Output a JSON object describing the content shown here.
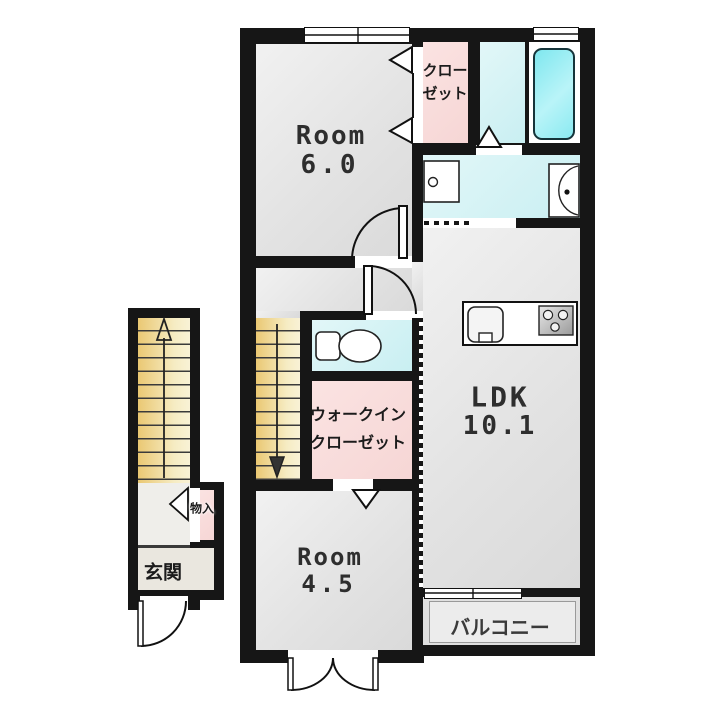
{
  "plan": {
    "rooms": {
      "room6": {
        "label": "Room",
        "area": "6.0"
      },
      "closet": {
        "label_line1": "クロー",
        "label_line2": "ゼット"
      },
      "ldk": {
        "label": "LDK",
        "area": "10.1"
      },
      "wic": {
        "label_line1": "ウォークイン",
        "label_line2": "クローゼット"
      },
      "room45": {
        "label": "Room",
        "area": "4.5"
      },
      "balcony": {
        "label": "バルコニー"
      },
      "genkan": {
        "label": "玄関"
      },
      "storage": {
        "label": "物入"
      }
    },
    "colors": {
      "wall": "#161616",
      "room_floor": "#e8e8e8",
      "closet_pink": "#f8dddc",
      "wet_area_cyan": "#d5f2f4",
      "bathtub_cyan": "#8ae9f0",
      "stairs_yellow": "#efd48e",
      "balcony_gray": "#e4e4e4"
    }
  }
}
